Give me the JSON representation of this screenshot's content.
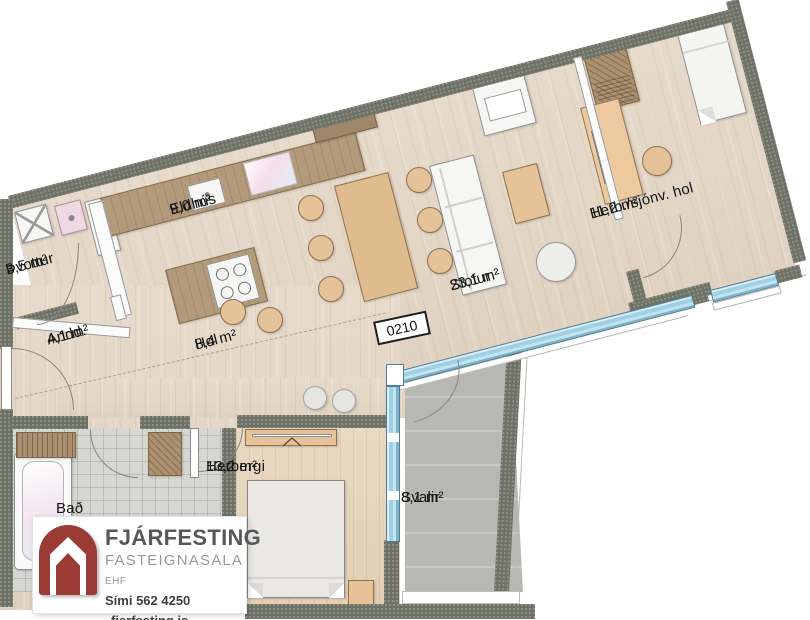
{
  "plate": {
    "number": "0210"
  },
  "rooms": [
    {
      "id": "thvottur",
      "name": "Þvottur",
      "area": "3,5 m²"
    },
    {
      "id": "eldhus",
      "name": "Eldhús",
      "area": "9,0 m²"
    },
    {
      "id": "andd",
      "name": "Andd.",
      "area": "4,1 m²"
    },
    {
      "id": "hol",
      "name": "Hol",
      "area": "8,4 m²"
    },
    {
      "id": "stofur",
      "name": "Stofur",
      "area": "23,1 m²"
    },
    {
      "id": "herb",
      "name": "Herb./sjónv. hol",
      "area": "11,2 m²"
    },
    {
      "id": "herbergi",
      "name": "Herbergi",
      "area": "13,2 m²"
    },
    {
      "id": "bad",
      "name": "Bað",
      "area": ""
    },
    {
      "id": "svalir",
      "name": "Svalir",
      "area": "8,1 m²"
    }
  ],
  "logo": {
    "brand": "FJÁRFESTING",
    "line2": "FASTEIGNASALA",
    "line2_suffix": "EHF",
    "phone": "Sími 562 4250",
    "website": "fjarfesting.is"
  },
  "colors": {
    "wall": "#6e7166",
    "floor_wood": "#e4d8c8",
    "counter_wood": "#b29a7b",
    "window_blue": "#9fd0e4",
    "balcony_gray": "#b7b8b4",
    "logo_red": "#9b3b36",
    "logo_gray": "#57585a"
  }
}
